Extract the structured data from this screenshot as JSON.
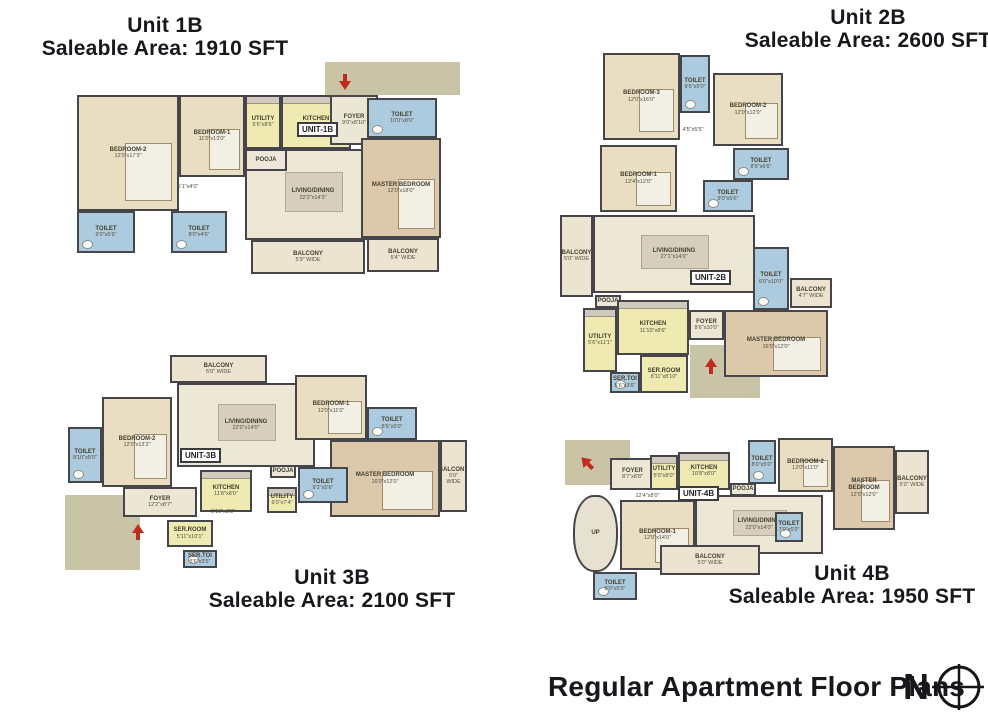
{
  "footer": {
    "title": "Regular Apartment Floor Plans",
    "compass_letter": "N"
  },
  "colors": {
    "wall": "#46464a",
    "header_ink": "#17171c",
    "entry_arrow_red": "#bf2b1e",
    "exterior_khaki": "#c9c4a6",
    "room_types": {
      "bedroom": "#e9ddc2",
      "master": "#dcc9ab",
      "living": "#ede7d6",
      "foyer": "#ece6d5",
      "pooja": "#ece7d8",
      "toilet": "#adcbde",
      "kitchen": "#efeab2",
      "ser": "#efeab2",
      "balcony": "#ece4d0",
      "stair": "#e7e1d1",
      "note": "transparent"
    }
  },
  "units": [
    {
      "name": "Unit 1B",
      "area_label": "Saleable Area: 1910 SFT",
      "tag": "UNIT-1B",
      "tag_pos": {
        "x": 222,
        "y": 60
      },
      "arrows": [
        {
          "x": 262,
          "y": 14,
          "dir": "down"
        }
      ],
      "exterior": [
        {
          "x": 250,
          "y": 0,
          "w": 135,
          "h": 33
        }
      ],
      "rooms": [
        {
          "label": "LIVING/DINING",
          "dims": "22'2\"x14'3\"",
          "type": "living",
          "x": 170,
          "y": 87,
          "w": 136,
          "h": 91
        },
        {
          "label": "BEDROOM-2",
          "dims": "12'0\"x17'3\"",
          "type": "bedroom",
          "x": 2,
          "y": 33,
          "w": 102,
          "h": 116
        },
        {
          "label": "BEDROOM-1",
          "dims": "11'0\"x13'0\"",
          "type": "bedroom",
          "x": 104,
          "y": 33,
          "w": 66,
          "h": 82
        },
        {
          "label": "UTILITY",
          "dims": "5'6\"x8'6\"",
          "type": "kitchen",
          "x": 170,
          "y": 33,
          "w": 36,
          "h": 54
        },
        {
          "label": "KITCHEN",
          "dims": "11'4\"x8'6\"",
          "type": "kitchen",
          "x": 206,
          "y": 33,
          "w": 70,
          "h": 54
        },
        {
          "label": "POOJA",
          "dims": "",
          "type": "pooja",
          "x": 170,
          "y": 87,
          "w": 42,
          "h": 22
        },
        {
          "label": "FOYER",
          "dims": "9'0\"x8'10\"",
          "type": "foyer",
          "x": 255,
          "y": 33,
          "w": 48,
          "h": 50
        },
        {
          "label": "TOILET",
          "dims": "10'0\"x8'0\"",
          "type": "toilet",
          "x": 292,
          "y": 36,
          "w": 70,
          "h": 40
        },
        {
          "label": "MASTER BEDROOM",
          "dims": "12'0\"x18'0\"",
          "type": "master",
          "x": 286,
          "y": 76,
          "w": 80,
          "h": 100
        },
        {
          "label": "TOILET",
          "dims": "9'0\"x5'6\"",
          "type": "toilet",
          "x": 2,
          "y": 149,
          "w": 58,
          "h": 42
        },
        {
          "label": "TOILET",
          "dims": "8'0\"x4'6\"",
          "type": "toilet",
          "x": 96,
          "y": 149,
          "w": 56,
          "h": 42
        },
        {
          "label": "",
          "dims": "5'1\"x4'0\"",
          "type": "note",
          "x": 88,
          "y": 120,
          "w": 50,
          "h": 10
        },
        {
          "label": "BALCONY",
          "dims": "5'9\" WIDE",
          "type": "balcony",
          "x": 176,
          "y": 178,
          "w": 114,
          "h": 34
        },
        {
          "label": "BALCONY",
          "dims": "5'4\" WIDE",
          "type": "balcony",
          "x": 292,
          "y": 176,
          "w": 72,
          "h": 34
        }
      ]
    },
    {
      "name": "Unit 2B",
      "area_label": "Saleable Area: 2600 SFT",
      "tag": "UNIT-2B",
      "tag_pos": {
        "x": 135,
        "y": 228
      },
      "arrows": [
        {
          "x": 148,
          "y": 318,
          "dir": "up"
        }
      ],
      "exterior": [
        {
          "x": 135,
          "y": 303,
          "w": 70,
          "h": 53
        }
      ],
      "rooms": [
        {
          "label": "LIVING/DINING",
          "dims": "27'1\"x14'0\"",
          "type": "living",
          "x": 38,
          "y": 173,
          "w": 162,
          "h": 78
        },
        {
          "label": "BEDROOM-3",
          "dims": "12'0\"x16'0\"",
          "type": "bedroom",
          "x": 48,
          "y": 11,
          "w": 77,
          "h": 87
        },
        {
          "label": "TOILET",
          "dims": "9'6\"x5'0\"",
          "type": "toilet",
          "x": 125,
          "y": 13,
          "w": 30,
          "h": 58
        },
        {
          "label": "BEDROOM-2",
          "dims": "12'0\"x12'0\"",
          "type": "bedroom",
          "x": 158,
          "y": 31,
          "w": 70,
          "h": 73
        },
        {
          "label": "TOILET",
          "dims": "8'6\"x6'6\"",
          "type": "toilet",
          "x": 178,
          "y": 106,
          "w": 56,
          "h": 32
        },
        {
          "label": "",
          "dims": "4'5\"x5'5\"",
          "type": "note",
          "x": 118,
          "y": 83,
          "w": 40,
          "h": 10
        },
        {
          "label": "BEDROOM-1",
          "dims": "13'4\"x12'0\"",
          "type": "bedroom",
          "x": 45,
          "y": 103,
          "w": 77,
          "h": 67
        },
        {
          "label": "TOILET",
          "dims": "9'0\"x5'6\"",
          "type": "toilet",
          "x": 148,
          "y": 138,
          "w": 50,
          "h": 32
        },
        {
          "label": "BALCONY",
          "dims": "5'0\" WIDE",
          "type": "balcony",
          "x": 5,
          "y": 173,
          "w": 33,
          "h": 82
        },
        {
          "label": "TOILET",
          "dims": "6'0\"x10'0\"",
          "type": "toilet",
          "x": 198,
          "y": 205,
          "w": 36,
          "h": 63
        },
        {
          "label": "BALCONY",
          "dims": "4'7\" WIDE",
          "type": "balcony",
          "x": 235,
          "y": 236,
          "w": 42,
          "h": 30
        },
        {
          "label": "POOJA",
          "dims": "",
          "type": "pooja",
          "x": 40,
          "y": 253,
          "w": 26,
          "h": 13
        },
        {
          "label": "KITCHEN",
          "dims": "11'10\"x8'6\"",
          "type": "kitchen",
          "x": 62,
          "y": 258,
          "w": 72,
          "h": 55
        },
        {
          "label": "UTILITY",
          "dims": "5'6\"x11'1\"",
          "type": "kitchen",
          "x": 28,
          "y": 266,
          "w": 34,
          "h": 64
        },
        {
          "label": "FOYER",
          "dims": "8'6\"x10'0\"",
          "type": "foyer",
          "x": 134,
          "y": 268,
          "w": 35,
          "h": 30
        },
        {
          "label": "MASTER BEDROOM",
          "dims": "16'0\"x12'0\"",
          "type": "master",
          "x": 169,
          "y": 268,
          "w": 104,
          "h": 67
        },
        {
          "label": "SER.ROOM",
          "dims": "8'11\"x8'10\"",
          "type": "ser",
          "x": 85,
          "y": 313,
          "w": 48,
          "h": 38
        },
        {
          "label": "SER.TOI",
          "dims": "5'6\"x3'6\"",
          "type": "toilet",
          "x": 55,
          "y": 330,
          "w": 30,
          "h": 21
        }
      ]
    },
    {
      "name": "Unit 3B",
      "area_label": "Saleable Area: 2100 SFT",
      "tag": "UNIT-3B",
      "tag_pos": {
        "x": 145,
        "y": 100
      },
      "arrows": [
        {
          "x": 95,
          "y": 178,
          "dir": "up"
        }
      ],
      "exterior": [
        {
          "x": 30,
          "y": 147,
          "w": 75,
          "h": 75
        }
      ],
      "rooms": [
        {
          "label": "LIVING/DINING",
          "dims": "22'0\"x14'0\"",
          "type": "living",
          "x": 142,
          "y": 35,
          "w": 138,
          "h": 84
        },
        {
          "label": "BALCONY",
          "dims": "5'0\" WIDE",
          "type": "balcony",
          "x": 135,
          "y": 7,
          "w": 97,
          "h": 28
        },
        {
          "label": "TOILET",
          "dims": "8'10\"x5'0\"",
          "type": "toilet",
          "x": 33,
          "y": 79,
          "w": 34,
          "h": 56
        },
        {
          "label": "BEDROOM-2",
          "dims": "12'0\"x13'2\"",
          "type": "bedroom",
          "x": 67,
          "y": 49,
          "w": 70,
          "h": 90
        },
        {
          "label": "BEDROOM-1",
          "dims": "12'0\"x11'0\"",
          "type": "bedroom",
          "x": 260,
          "y": 27,
          "w": 72,
          "h": 65
        },
        {
          "label": "TOILET",
          "dims": "8'6\"x5'0\"",
          "type": "toilet",
          "x": 332,
          "y": 59,
          "w": 50,
          "h": 33
        },
        {
          "label": "MASTER BEDROOM",
          "dims": "16'0\"x12'0\"",
          "type": "master",
          "x": 295,
          "y": 92,
          "w": 110,
          "h": 77
        },
        {
          "label": "BALCONY",
          "dims": "5'0\" WIDE",
          "type": "balcony",
          "x": 405,
          "y": 92,
          "w": 27,
          "h": 72
        },
        {
          "label": "TOILET",
          "dims": "9'2\"x5'6\"",
          "type": "toilet",
          "x": 263,
          "y": 119,
          "w": 50,
          "h": 36
        },
        {
          "label": "POOJA",
          "dims": "",
          "type": "pooja",
          "x": 235,
          "y": 117,
          "w": 26,
          "h": 13
        },
        {
          "label": "UTILITY",
          "dims": "6'0\"x7'4\"",
          "type": "kitchen",
          "x": 232,
          "y": 139,
          "w": 30,
          "h": 26
        },
        {
          "label": "KITCHEN",
          "dims": "11'8\"x8'0\"",
          "type": "kitchen",
          "x": 165,
          "y": 122,
          "w": 52,
          "h": 42
        },
        {
          "label": "FOYER",
          "dims": "12'2\"x8'7\"",
          "type": "foyer",
          "x": 88,
          "y": 139,
          "w": 74,
          "h": 30
        },
        {
          "label": "SER.ROOM",
          "dims": "5'11\"x10'1\"",
          "type": "ser",
          "x": 132,
          "y": 172,
          "w": 46,
          "h": 27
        },
        {
          "label": "",
          "dims": "5'10\"x8'8\"",
          "type": "note",
          "x": 168,
          "y": 160,
          "w": 40,
          "h": 9
        },
        {
          "label": "SER.TOI",
          "dims": "5'6\"x3'5\"",
          "type": "toilet",
          "x": 148,
          "y": 202,
          "w": 34,
          "h": 18
        }
      ]
    },
    {
      "name": "Unit 4B",
      "area_label": "Saleable Area: 1950 SFT",
      "tag": "UNIT-4B",
      "tag_pos": {
        "x": 113,
        "y": 54
      },
      "arrows": [
        {
          "x": 14,
          "y": 25,
          "dir": "upleft"
        }
      ],
      "exterior": [
        {
          "x": 0,
          "y": 8,
          "w": 65,
          "h": 45
        }
      ],
      "rooms": [
        {
          "label": "LIVING/DINING",
          "dims": "22'0\"x14'0\"",
          "type": "living",
          "x": 130,
          "y": 63,
          "w": 128,
          "h": 59
        },
        {
          "label": "UP",
          "dims": "",
          "type": "stair",
          "x": 8,
          "y": 63,
          "w": 45,
          "h": 77
        },
        {
          "label": "TOILET",
          "dims": "8'0\"x5'0\"",
          "type": "toilet",
          "x": 28,
          "y": 140,
          "w": 44,
          "h": 28
        },
        {
          "label": "FOYER",
          "dims": "8'7\"x8'8\"",
          "type": "foyer",
          "x": 45,
          "y": 26,
          "w": 45,
          "h": 32
        },
        {
          "label": "UTILITY",
          "dims": "5'0\"x8'0\"",
          "type": "kitchen",
          "x": 85,
          "y": 23,
          "w": 28,
          "h": 35
        },
        {
          "label": "KITCHEN",
          "dims": "10'8\"x8'0\"",
          "type": "kitchen",
          "x": 113,
          "y": 20,
          "w": 52,
          "h": 38
        },
        {
          "label": "POOJA",
          "dims": "",
          "type": "pooja",
          "x": 165,
          "y": 51,
          "w": 26,
          "h": 13
        },
        {
          "label": "TOILET",
          "dims": "8'0\"x5'0\"",
          "type": "toilet",
          "x": 183,
          "y": 8,
          "w": 28,
          "h": 44
        },
        {
          "label": "BEDROOM-2",
          "dims": "12'0\"x11'0\"",
          "type": "bedroom",
          "x": 213,
          "y": 6,
          "w": 55,
          "h": 54
        },
        {
          "label": "MASTER BEDROOM",
          "dims": "12'0\"x12'0\"",
          "type": "master",
          "x": 268,
          "y": 14,
          "w": 62,
          "h": 84
        },
        {
          "label": "BALCONY",
          "dims": "5'0\" WIDE",
          "type": "balcony",
          "x": 330,
          "y": 18,
          "w": 34,
          "h": 64
        },
        {
          "label": "BEDROOM-1",
          "dims": "12'0\"x14'0\"",
          "type": "bedroom",
          "x": 55,
          "y": 68,
          "w": 75,
          "h": 70
        },
        {
          "label": "TOILET",
          "dims": "7'0\"x5'0\"",
          "type": "toilet",
          "x": 210,
          "y": 80,
          "w": 28,
          "h": 30
        },
        {
          "label": "BALCONY",
          "dims": "5'0\" WIDE",
          "type": "balcony",
          "x": 95,
          "y": 113,
          "w": 100,
          "h": 30
        },
        {
          "label": "",
          "dims": "12'4\"x8'0\"",
          "type": "note",
          "x": 60,
          "y": 60,
          "w": 45,
          "h": 9
        }
      ]
    }
  ]
}
